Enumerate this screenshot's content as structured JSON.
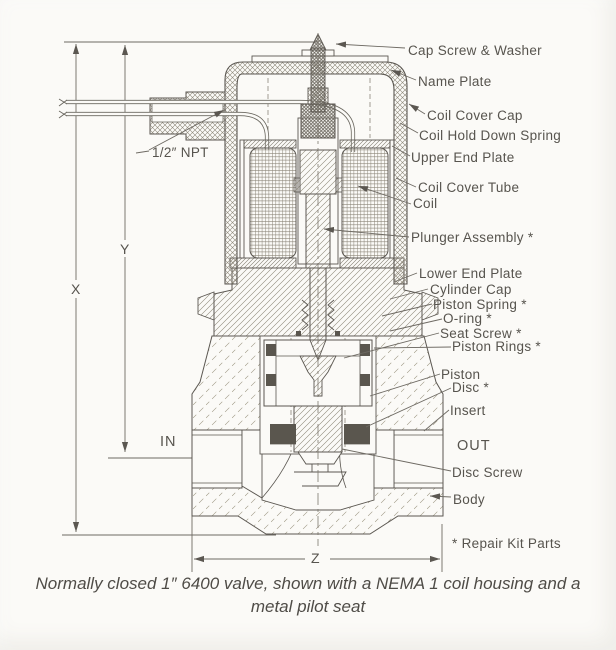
{
  "title": "Solenoid valve cross-section diagram",
  "labels": {
    "cap_screw_washer": "Cap Screw & Washer",
    "name_plate": "Name Plate",
    "coil_cover_cap": "Coil Cover Cap",
    "coil_hold_down_spring": "Coil Hold Down Spring",
    "upper_end_plate": "Upper End Plate",
    "coil_cover_tube": "Coil Cover Tube",
    "coil": "Coil",
    "plunger_assembly": "Plunger Assembly *",
    "lower_end_plate": "Lower End Plate",
    "cylinder_cap": "Cylinder Cap",
    "piston_spring": "Piston Spring *",
    "o_ring": "O-ring *",
    "seat_screw": "Seat Screw *",
    "piston_rings": "Piston Rings *",
    "piston": "Piston",
    "disc": "Disc *",
    "insert": "Insert",
    "disc_screw": "Disc Screw",
    "body": "Body",
    "footnote": "* Repair Kit Parts"
  },
  "dimensions": {
    "x": "X",
    "y": "Y",
    "z": "Z",
    "npt": "1/2″ NPT",
    "in": "IN",
    "out": "OUT"
  },
  "caption": [
    "Normally closed 1″ 6400 valve, shown with a NEMA 1 coil housing and a",
    "metal pilot seat"
  ],
  "colors": {
    "ink": "#5b5751",
    "hatch": "#8d8779",
    "dark_fill": "#5a564e",
    "background": "#fbfaf7",
    "text": "#57544e"
  }
}
